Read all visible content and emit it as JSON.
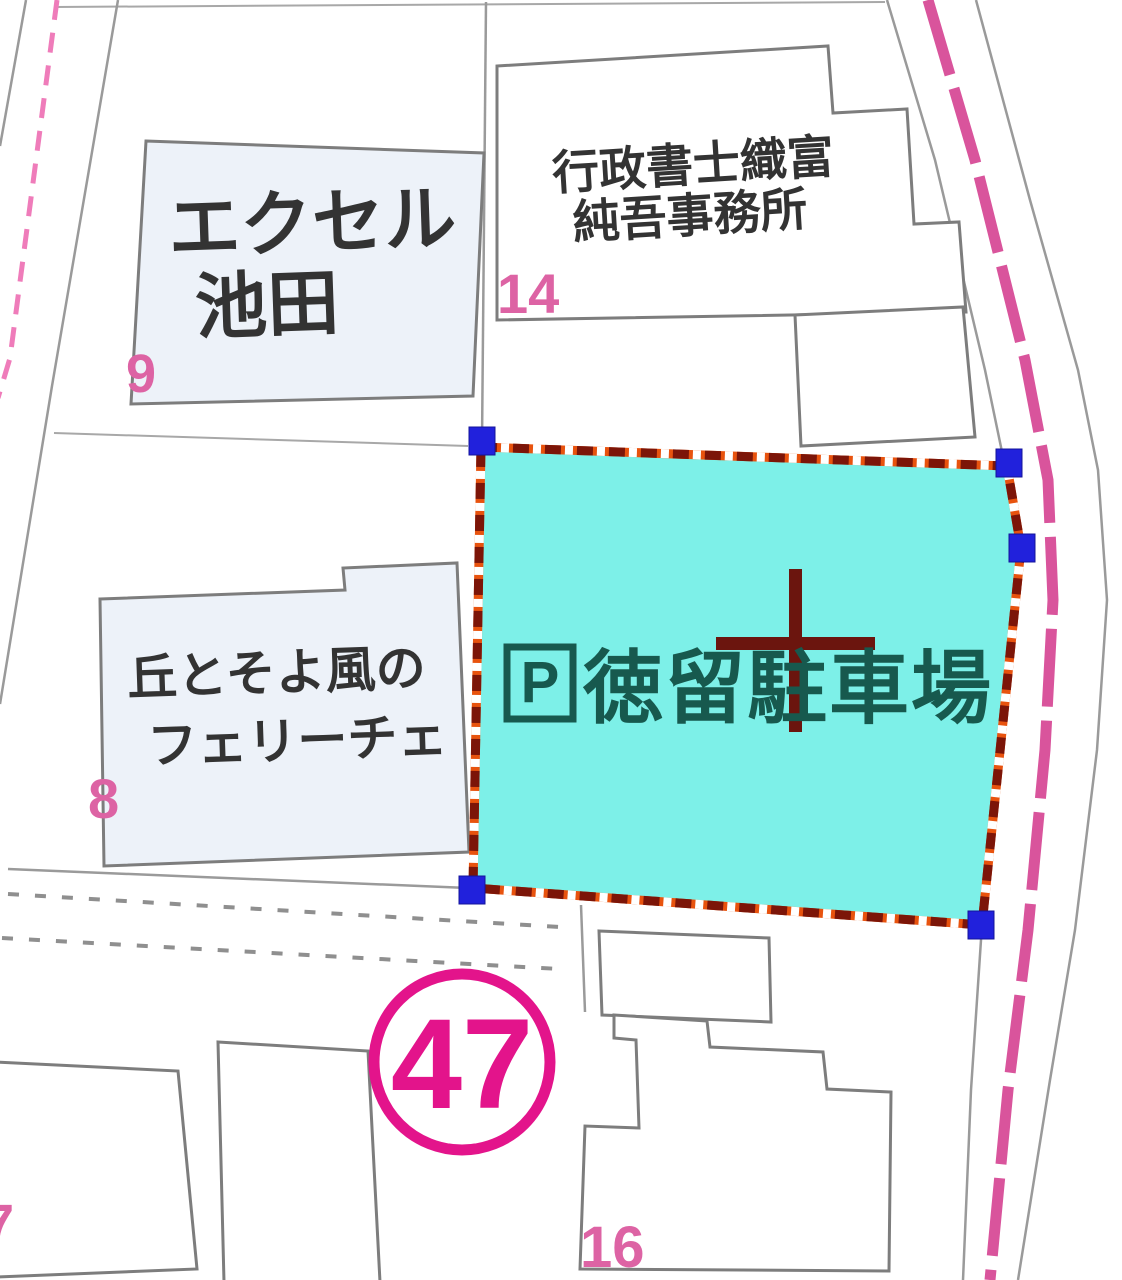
{
  "map": {
    "buildings": [
      {
        "lines": [
          "エクセル",
          "池田"
        ],
        "number": "9"
      },
      {
        "lines": [
          "行政書士織富",
          "純吾事務所"
        ],
        "number": "14"
      },
      {
        "lines": [
          "丘とそよ風の",
          "フェリーチェ"
        ],
        "number": "8"
      },
      {
        "lines": [],
        "number": "7"
      },
      {
        "lines": [],
        "number": "16"
      }
    ],
    "selected_parcel": {
      "symbol": "P",
      "label": "徳留駐車場",
      "handle_count": 5
    },
    "route_marker": {
      "number": "47"
    },
    "colors": {
      "selection_fill": "#7df0e8",
      "selection_border_base": "#e8530e",
      "selection_border_dash": "#7c1508",
      "selection_border_dash2": "#ffffff",
      "selection_handle": "#2121dc",
      "crosshair": "#6b150e",
      "parking_text": "#17594e",
      "route_pink_road": "#d9549c",
      "boundary_pink": "#ef7cba",
      "parcel_number_pink": "#dd63a4",
      "route_marker_pink": "#e3148b",
      "building_fill_blue": "#edf2f9",
      "building_text": "#333333"
    }
  }
}
